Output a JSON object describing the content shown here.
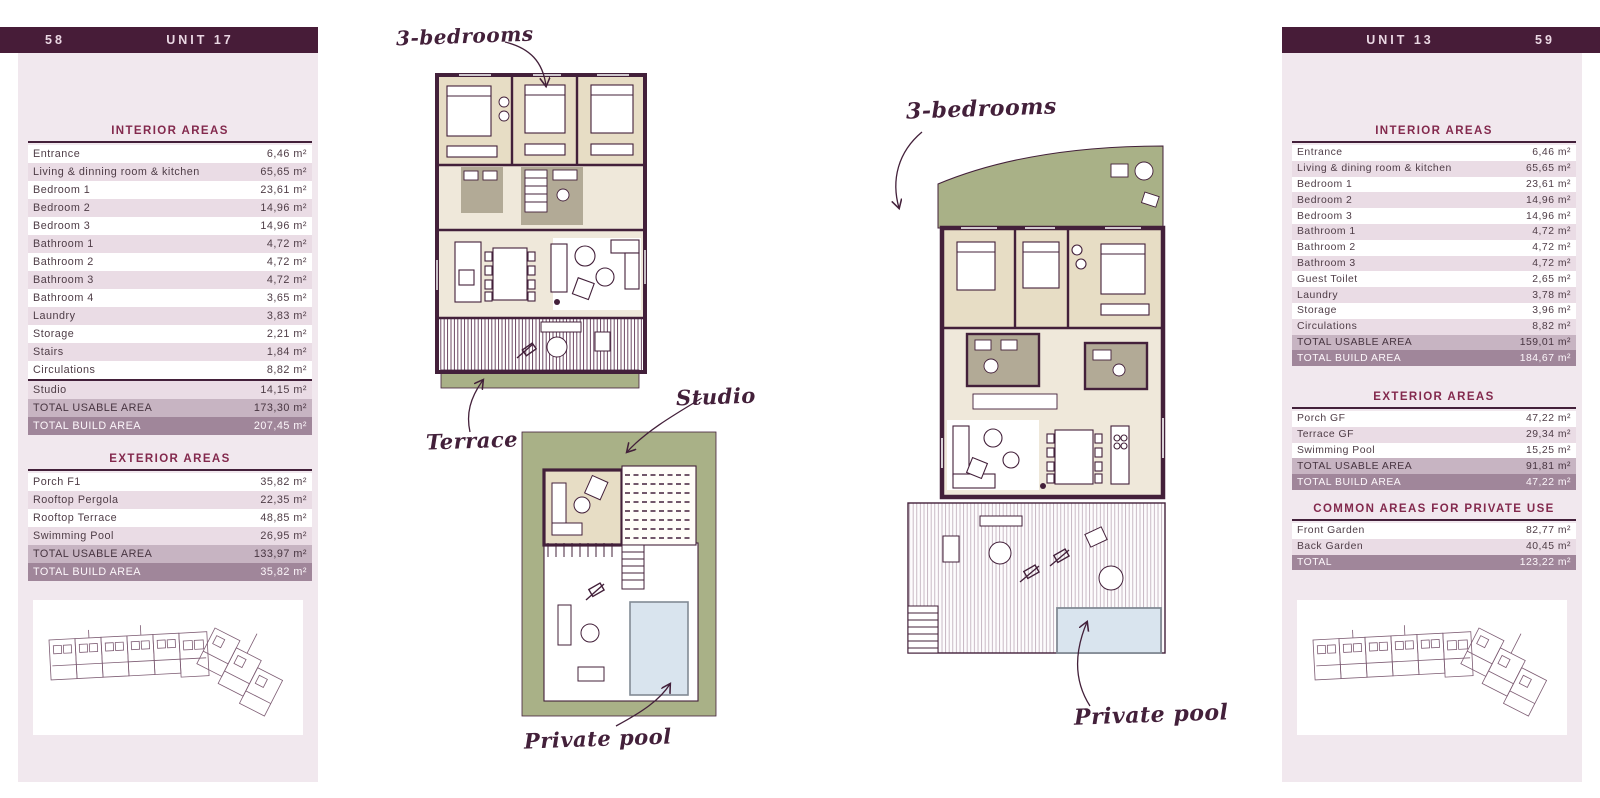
{
  "pages": {
    "left": {
      "page_number": "58",
      "unit_label": "UNIT 17",
      "sections": [
        {
          "title": "INTERIOR AREAS",
          "rows": [
            {
              "label": "Entrance",
              "value": "6,46 m²",
              "type": "normal"
            },
            {
              "label": "Living & dinning room & kitchen",
              "value": "65,65 m²",
              "type": "normal"
            },
            {
              "label": "Bedroom 1",
              "value": "23,61 m²",
              "type": "normal"
            },
            {
              "label": "Bedroom 2",
              "value": "14,96 m²",
              "type": "normal"
            },
            {
              "label": "Bedroom 3",
              "value": "14,96 m²",
              "type": "normal"
            },
            {
              "label": "Bathroom 1",
              "value": "4,72 m²",
              "type": "normal"
            },
            {
              "label": "Bathroom 2",
              "value": "4,72 m²",
              "type": "normal"
            },
            {
              "label": "Bathroom 3",
              "value": "4,72 m²",
              "type": "normal"
            },
            {
              "label": "Bathroom 4",
              "value": "3,65 m²",
              "type": "normal"
            },
            {
              "label": "Laundry",
              "value": "3,83 m²",
              "type": "normal"
            },
            {
              "label": "Storage",
              "value": "2,21 m²",
              "type": "normal"
            },
            {
              "label": "Stairs",
              "value": "1,84 m²",
              "type": "normal"
            },
            {
              "label": "Circulations",
              "value": "8,82 m²",
              "type": "normal"
            },
            {
              "label": "Studio",
              "value": "14,15 m²",
              "type": "normal",
              "sep": true
            },
            {
              "label": "TOTAL USABLE AREA",
              "value": "173,30 m²",
              "type": "usable"
            },
            {
              "label": "TOTAL BUILD AREA",
              "value": "207,45 m²",
              "type": "build"
            }
          ]
        },
        {
          "title": "EXTERIOR AREAS",
          "rows": [
            {
              "label": "Porch F1",
              "value": "35,82 m²",
              "type": "normal"
            },
            {
              "label": "Rooftop Pergola",
              "value": "22,35 m²",
              "type": "normal"
            },
            {
              "label": "Rooftop Terrace",
              "value": "48,85 m²",
              "type": "normal"
            },
            {
              "label": "Swimming Pool",
              "value": "26,95 m²",
              "type": "normal"
            },
            {
              "label": "TOTAL USABLE AREA",
              "value": "133,97 m²",
              "type": "usable"
            },
            {
              "label": "TOTAL BUILD AREA",
              "value": "35,82 m²",
              "type": "build"
            }
          ]
        }
      ]
    },
    "right": {
      "page_number": "59",
      "unit_label": "UNIT 13",
      "sections": [
        {
          "title": "INTERIOR AREAS",
          "rows": [
            {
              "label": "Entrance",
              "value": "6,46 m²",
              "type": "normal"
            },
            {
              "label": "Living & dining room & kitchen",
              "value": "65,65 m²",
              "type": "normal"
            },
            {
              "label": "Bedroom 1",
              "value": "23,61 m²",
              "type": "normal"
            },
            {
              "label": "Bedroom 2",
              "value": "14,96 m²",
              "type": "normal"
            },
            {
              "label": "Bedroom 3",
              "value": "14,96 m²",
              "type": "normal"
            },
            {
              "label": "Bathroom 1",
              "value": "4,72 m²",
              "type": "normal"
            },
            {
              "label": "Bathroom 2",
              "value": "4,72 m²",
              "type": "normal"
            },
            {
              "label": "Bathroom 3",
              "value": "4,72 m²",
              "type": "normal"
            },
            {
              "label": "Guest Toilet",
              "value": "2,65 m²",
              "type": "normal"
            },
            {
              "label": "Laundry",
              "value": "3,78 m²",
              "type": "normal"
            },
            {
              "label": "Storage",
              "value": "3,96 m²",
              "type": "normal"
            },
            {
              "label": "Circulations",
              "value": "8,82 m²",
              "type": "normal"
            },
            {
              "label": "TOTAL USABLE AREA",
              "value": "159,01 m²",
              "type": "usable"
            },
            {
              "label": "TOTAL BUILD AREA",
              "value": "184,67 m²",
              "type": "build"
            }
          ]
        },
        {
          "title": "EXTERIOR AREAS",
          "rows": [
            {
              "label": "Porch GF",
              "value": "47,22 m²",
              "type": "normal"
            },
            {
              "label": "Terrace GF",
              "value": "29,34 m²",
              "type": "normal"
            },
            {
              "label": "Swimming Pool",
              "value": "15,25 m²",
              "type": "normal"
            },
            {
              "label": "TOTAL USABLE AREA",
              "value": "91,81 m²",
              "type": "usable"
            },
            {
              "label": "TOTAL BUILD AREA",
              "value": "47,22 m²",
              "type": "build"
            }
          ]
        },
        {
          "title": "COMMON AREAS FOR PRIVATE USE",
          "rows": [
            {
              "label": "Front Garden",
              "value": "82,77 m²",
              "type": "normal"
            },
            {
              "label": "Back Garden",
              "value": "40,45 m²",
              "type": "normal"
            },
            {
              "label": "TOTAL",
              "value": "123,22 m²",
              "type": "build"
            }
          ]
        }
      ]
    }
  },
  "annotations": {
    "unit17_bedrooms": "3-bedrooms",
    "unit17_terrace": "Terrace",
    "unit17_studio": "Studio",
    "unit17_pool": "Private pool",
    "unit13_bedrooms": "3-bedrooms",
    "unit13_pool": "Private pool"
  },
  "colors": {
    "header_bar": "#471c38",
    "panel_background": "#f1e8ee",
    "row_alt": "#eadce5",
    "total_usable_row": "#c7b4c2",
    "total_build_row": "#a0869a",
    "heading_text": "#83294d",
    "wall": "#43203a",
    "bedroom_fill": "#e7ddc5",
    "bathroom_fill": "#b2aa96",
    "living_fill": "#efe8da",
    "garden_green": "#a9b187",
    "pool_blue": "#d9e4ee"
  }
}
